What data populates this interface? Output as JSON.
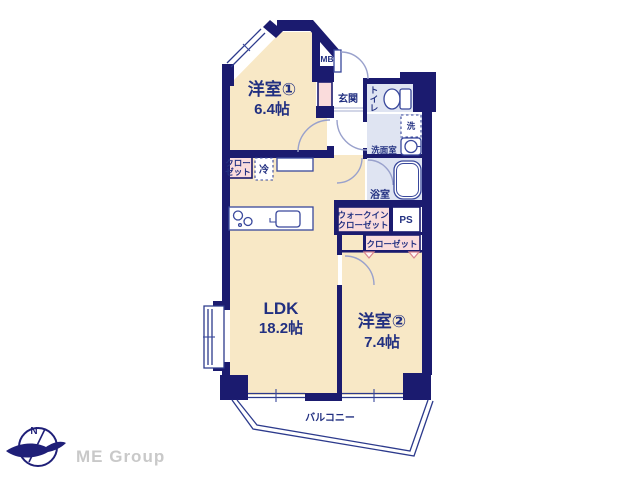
{
  "branding": {
    "company": "ME Group",
    "compass_north": "N"
  },
  "rooms": {
    "bedroom1": {
      "name": "洋室①",
      "size": "6.4帖"
    },
    "bedroom2": {
      "name": "洋室②",
      "size": "7.4帖"
    },
    "ldk": {
      "name": "LDK",
      "size": "18.2帖"
    },
    "entrance": {
      "label": "玄関"
    },
    "toilet": {
      "label": "トイレ",
      "c1": "ト",
      "c2": "イ",
      "c3": "レ"
    },
    "washroom": {
      "label": "洗面室"
    },
    "washing_machine": {
      "label": "洗"
    },
    "bathroom": {
      "label": "浴室"
    },
    "walk_in_closet": {
      "line1": "ウォークイン",
      "line2": "クローゼット"
    },
    "closet_bedroom2": {
      "label": "クローゼット"
    },
    "closet_bedroom1": {
      "line1": "クロー",
      "line2": "ゼット"
    },
    "refrigerator": {
      "label": "冷"
    },
    "meter_box": {
      "label": "MB"
    },
    "pipe_space": {
      "label": "PS"
    },
    "balcony": {
      "label": "バルコニー"
    }
  },
  "colors": {
    "wall_navy": "#1b1b6f",
    "room_cream": "#f8e8c6",
    "closet_pink": "#fadcdc",
    "wet_area_blue": "#dfe4f2",
    "text_navy": "#223081",
    "door_arc": "#99a1cc",
    "logo_grey": "#c9c9c9"
  }
}
